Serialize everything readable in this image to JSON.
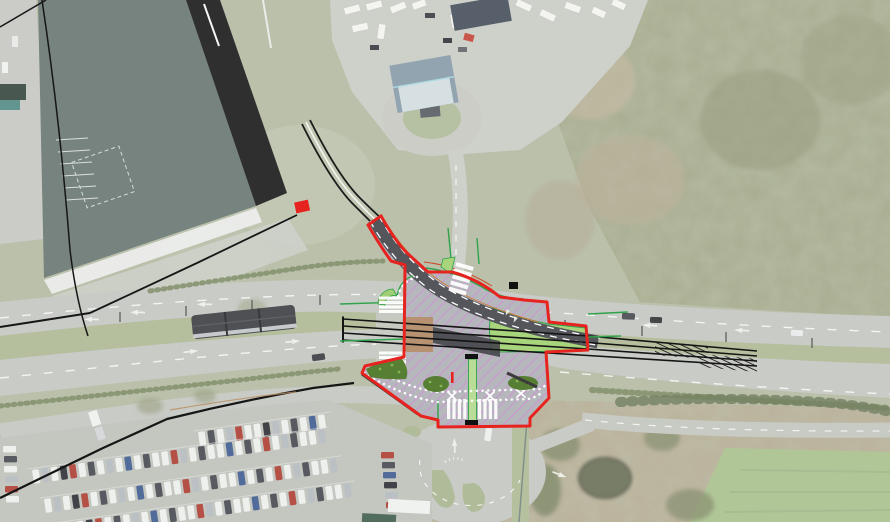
{
  "app": {
    "name": "aerial-site-plan",
    "description": "Engineering CAD overlay of a proposed tram crossing junction drawn over an aerial photograph",
    "canvas": {
      "width": 890,
      "height": 522
    }
  },
  "overlay": {
    "boundary": {
      "label": "site-boundary",
      "color": "#e6231e"
    },
    "surface": {
      "label": "proposed-junction-surface",
      "fill": "#b6b6bd",
      "hatch_color": "#df7fdf"
    },
    "tracks": {
      "label": "tram-tracks",
      "color": "#141414",
      "count": 4
    },
    "tram_route": {
      "label": "proposed-tram-alignment",
      "fill": "#55565c",
      "edge_dash_color": "#ffffff",
      "edge_accent_color": "#c87f3a"
    },
    "kerbs": {
      "label": "kerb-lines",
      "color": "#2fa34b"
    },
    "grass_track": {
      "label": "grass-track-panel",
      "fill": "#a8d47c"
    },
    "crossing_slab": {
      "label": "track-crossing-slab",
      "fill": "#b79272"
    },
    "hedges": {
      "label": "proposed-planting",
      "fill": "#567f33"
    },
    "crossings": {
      "label": "zebra-crossings",
      "color": "#ffffff",
      "count": 5
    },
    "cycle_path": {
      "label": "shared-path-dotted-markings",
      "color": "#ffffff"
    },
    "marker": {
      "label": "red-marker",
      "fill": "#e6231e"
    }
  },
  "aerial": {
    "building_roof": "#5e6e69",
    "building_edge_band": "#0b0b0b",
    "road": "#c0c2bc",
    "median_grass": "#a9b48d",
    "woodland": "#9aa07e",
    "scrub": "#b0a489",
    "field": "#a3bd85",
    "parking_asphalt": "#babdb6",
    "features": [
      "industrial-building",
      "caravan-park",
      "woodland",
      "dual-carriageway",
      "tram-on-median",
      "car-park",
      "roundabout",
      "field"
    ]
  }
}
